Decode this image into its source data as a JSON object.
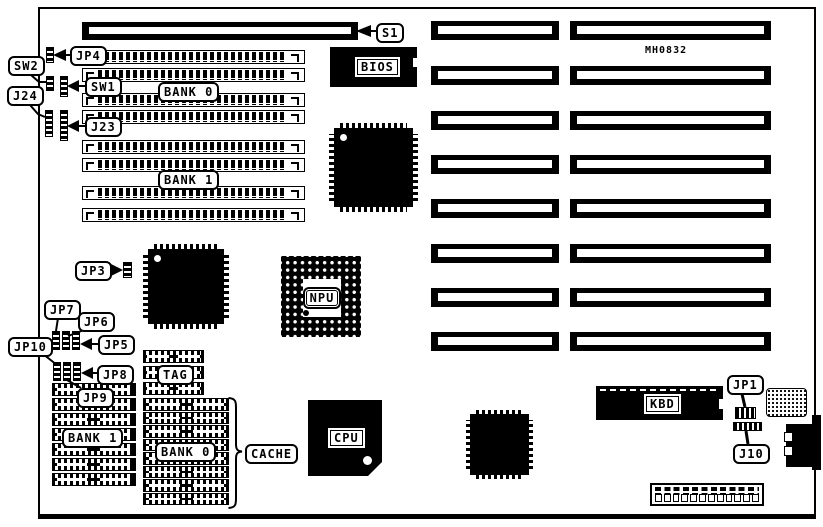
{
  "diagram": {
    "part_number": "MH0832",
    "ink_color": "#000000",
    "paper_color": "#ffffff"
  },
  "callouts": {
    "s1": "S1",
    "jp4": "JP4",
    "sw2": "SW2",
    "j24": "J24",
    "sw1": "SW1",
    "j23": "J23",
    "jp3": "JP3",
    "jp7": "JP7",
    "jp6": "JP6",
    "jp5": "JP5",
    "jp10": "JP10",
    "jp8": "JP8",
    "jp9": "JP9",
    "jp1": "JP1",
    "j10": "J10",
    "cache": "CACHE"
  },
  "memory": {
    "bank0_label": "BANK 0",
    "bank1_label": "BANK 1"
  },
  "cache": {
    "tag_label": "TAG",
    "bank0_label": "BANK 0",
    "bank1_label": "BANK 1"
  },
  "chips": {
    "bios": "BIOS",
    "npu": "NPU",
    "cpu": "CPU",
    "kbd": "KBD"
  }
}
